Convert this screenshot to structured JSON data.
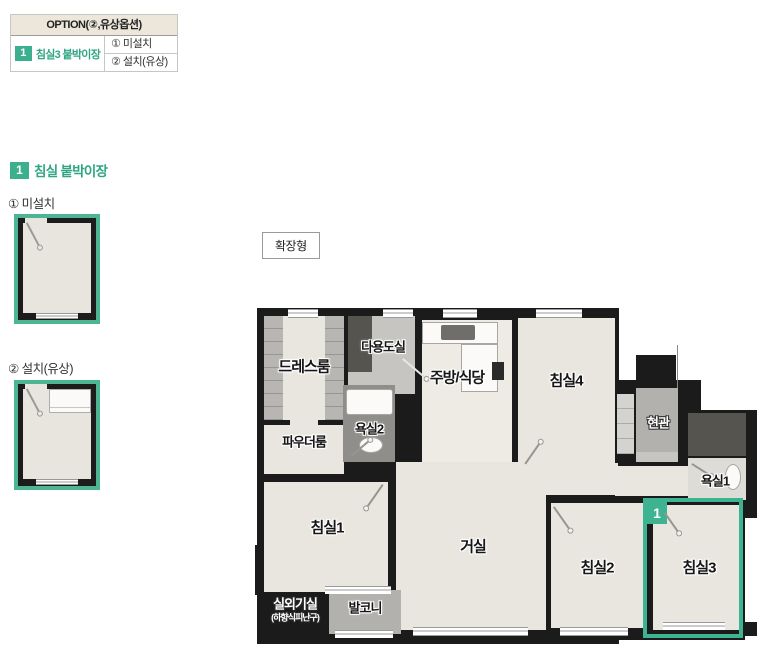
{
  "colors": {
    "accent": "#3cb08e",
    "table_header_bg": "#ece7da",
    "wall": "#1b1b1b",
    "floor": "#e9e6df"
  },
  "option_table": {
    "header": "OPTION(②,유상옵션)",
    "row_badge": "1",
    "row_label": "침실3 붙박이장",
    "options": [
      "① 미설치",
      "② 설치(유상)"
    ]
  },
  "detail": {
    "badge": "1",
    "title": "침실 붙박이장",
    "variant1_label": "① 미설치",
    "variant2_label": "② 설치(유상)"
  },
  "plan": {
    "type_button": "확장형",
    "highlight_badge": "1",
    "rooms": {
      "dress": "드레스룸",
      "utility": "다용도실",
      "kitchen": "주방/식당",
      "bed4": "침실4",
      "entrance": "현관",
      "bath2": "욕실2",
      "powder": "파우더룸",
      "bath1": "욕실1",
      "bed1": "침실1",
      "living": "거실",
      "bed2": "침실2",
      "bed3": "침실3",
      "outdoor": "실외기실",
      "outdoor_sub": "(하향식피난구)",
      "balcony": "발코니"
    }
  }
}
